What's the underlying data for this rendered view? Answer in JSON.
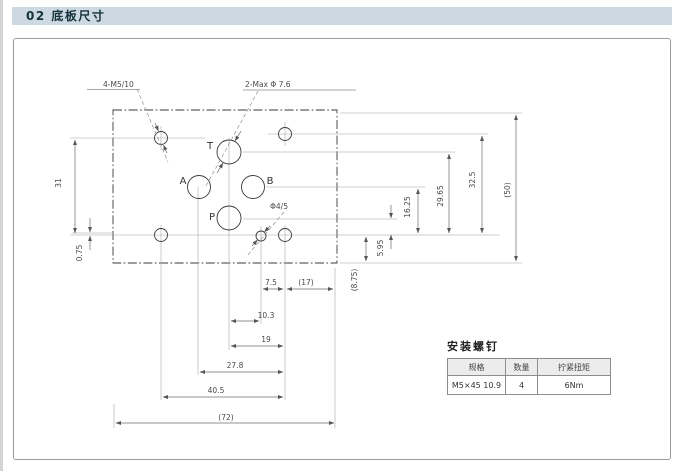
{
  "page": {
    "header_title": "02 底板尺寸"
  },
  "drawing": {
    "callouts": {
      "mount": "4-M5/10",
      "max": "2-Max Φ 7.6",
      "pilot": "Φ4/5"
    },
    "ports": {
      "t": "T",
      "a": "A",
      "b": "B",
      "p": "P"
    },
    "dims": {
      "d31": "31",
      "d075": "0.75",
      "d595": "5.95",
      "d1625": "16.25",
      "d2965": "29.65",
      "d325": "32.5",
      "d50": "(50)",
      "d875": "(8.75)",
      "d75": "7.5",
      "d17": "(17)",
      "d103": "10.3",
      "d19": "19",
      "d278": "27.8",
      "d405": "40.5",
      "d72": "(72)"
    }
  },
  "screw_table": {
    "title": "安装螺钉",
    "headers": [
      "规格",
      "数量",
      "拧紧扭矩"
    ],
    "rows": [
      [
        "M5×45 10.9",
        "4",
        "6Nm"
      ]
    ]
  },
  "colors": {
    "header_bg": "#ccd9e1",
    "header_text": "#16323c",
    "line_dark": "#3a3a3a",
    "line_light": "#9a9a9a",
    "dim_line": "#6b6b6b"
  }
}
